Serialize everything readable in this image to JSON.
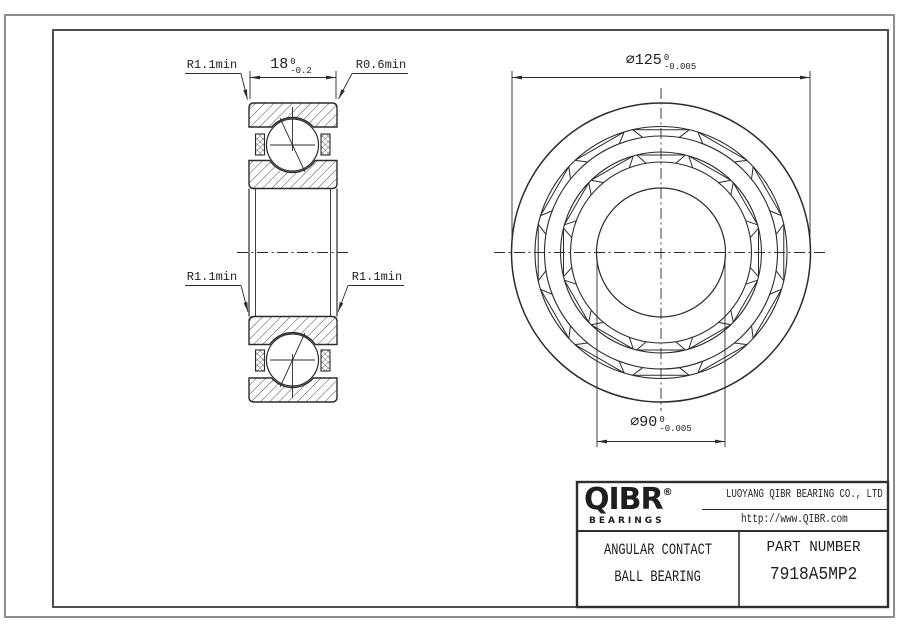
{
  "drawing": {
    "section_view": {
      "width_dim": {
        "value": "18",
        "tol_upper": "0",
        "tol_lower": "-0.2"
      },
      "radius_labels": {
        "top_left": "R1.1min",
        "top_right": "R0.6min",
        "mid_left": "R1.1min",
        "mid_right": "R1.1min"
      }
    },
    "front_view": {
      "outer_diameter_dim": {
        "value": "∅125",
        "tol_upper": "0",
        "tol_lower": "-0.005"
      },
      "bore_diameter_dim": {
        "value": "∅90",
        "tol_upper": "0",
        "tol_lower": "-0.005"
      }
    }
  },
  "title_block": {
    "logo_text": "QIBR",
    "logo_registered": "®",
    "logo_subtext": "BEARINGS",
    "company_name": "LUOYANG QIBR BEARING CO., LTD",
    "website": "http://www.QIBR.com",
    "product_type_line1": "ANGULAR CONTACT",
    "product_type_line2": "BALL BEARING",
    "part_number_label": "PART NUMBER",
    "part_number": "7918A5MP2"
  },
  "colors": {
    "line": "#2b2b2b",
    "background": "#ffffff",
    "border": "#4f4f4f"
  }
}
